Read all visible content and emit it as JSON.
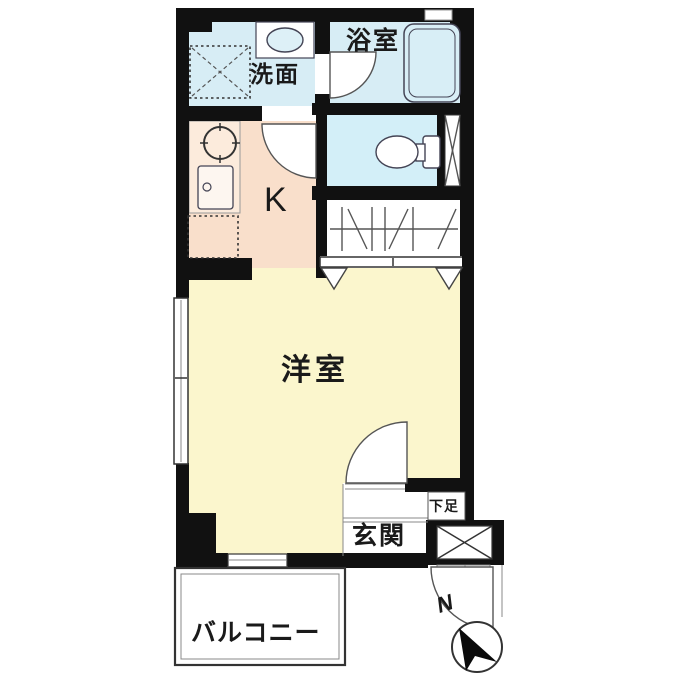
{
  "floorplan": {
    "type": "apartment-floor-plan",
    "labels": {
      "bathroom": "浴室",
      "washroom": "洗面",
      "kitchen": "K",
      "western_room": "洋室",
      "entrance": "玄関",
      "shoe_storage": "下足",
      "balcony": "バルコニー",
      "compass_north": "N"
    },
    "colors": {
      "wall": "#111111",
      "room_yellow": "#fbf6cd",
      "kitchen_pink": "#f9dfcb",
      "counter_pink": "#fcebdc",
      "wet_blue": "#d7edf5",
      "toilet_blue": "#d3eff8",
      "line": "#555555"
    },
    "icons": [
      "bathtub-icon",
      "vanity-sink-icon",
      "washing-machine-space-icon",
      "toilet-icon",
      "stove-icon",
      "kitchen-sink-icon",
      "refrigerator-space-icon",
      "closet-hanger-icon",
      "pipe-space-x-icon",
      "door-swing-icon",
      "window-icon",
      "compass-icon"
    ]
  }
}
